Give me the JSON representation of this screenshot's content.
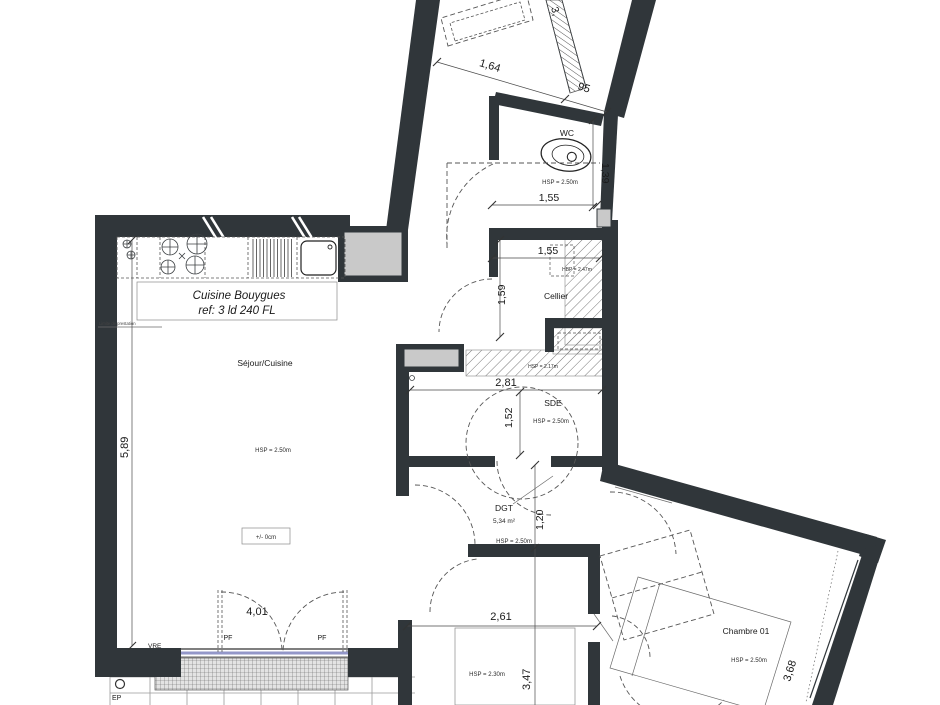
{
  "title": "Apartment floor plan - 3 rooms",
  "colors": {
    "wall": "#30363a",
    "shaft_gray": "#c9c9c9",
    "window_sill_blue": "#9397c9",
    "hatch": "#777777"
  },
  "rooms": {
    "wc": {
      "name": "WC",
      "height": "HSP = 2.50m"
    },
    "cellier": {
      "name": "Cellier",
      "height_low": "HBP = 2.47m"
    },
    "soffit": {
      "height": "HSP = 2.17m"
    },
    "sde": {
      "name": "SDE",
      "height": "HSP = 2.50m"
    },
    "dgt": {
      "name": "DGT",
      "area": "5,34 m²",
      "height": "HSP = 2.50m"
    },
    "sejour": {
      "name": "Séjour/Cuisine",
      "height": "HSP = 2.50m"
    },
    "lower": {
      "height": "HSP = 2.30m"
    },
    "chambre1": {
      "name": "Chambre 01",
      "height": "HSP = 2.50m"
    }
  },
  "kitchen": {
    "title": "Cuisine Bouygues",
    "ref": "ref: 3 ld 240 FL",
    "note": "Limite de prestation"
  },
  "dimensions": {
    "entry_w": "1,64",
    "entry_d": "95",
    "top_partial": "3,",
    "wc_w": "1,55",
    "wc_d": "1,39",
    "cellier_w": "1,55",
    "cellier_d": "1,59",
    "sde_w": "2,81",
    "sde_h": "1,52",
    "dgt_d": "1,20",
    "sejour_d": "5,89",
    "window_w": "4,01",
    "corridor_w": "2,61",
    "room_d": "3,47",
    "chambre_d": "3,68"
  },
  "annotations": {
    "level": "+/- 0cm",
    "pf": "PF",
    "vre": "VRE",
    "ep": "EP"
  }
}
